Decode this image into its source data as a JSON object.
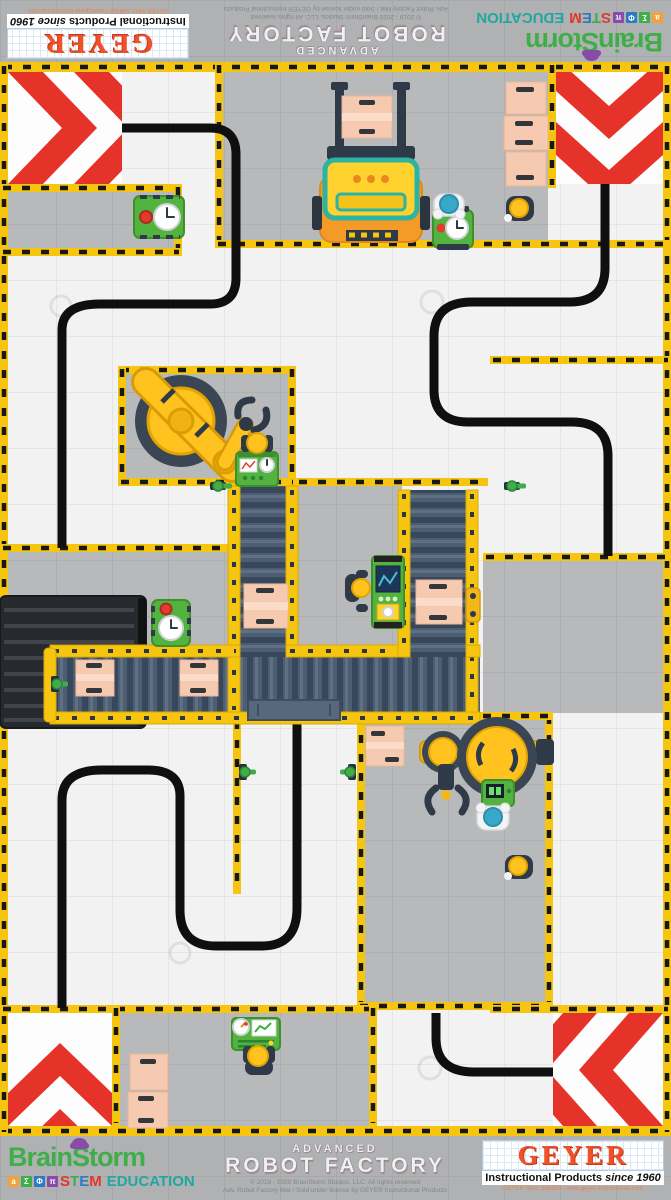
{
  "branding": {
    "brainstorm": {
      "name": "BrainStorm",
      "blocks": [
        "a",
        "Σ",
        "Φ",
        "π"
      ],
      "stem_letters": [
        "S",
        "T",
        "E",
        "M"
      ],
      "education": "EDUCATION"
    },
    "product": {
      "advanced": "ADVANCED",
      "robot_factory": "ROBOT FACTORY",
      "copyright": "© 2019 - 2020 BrainStorm Studios, LLC. All rights reserved",
      "license": "Adv. Robot Factory Mat / Sold under license by GEYER Instructional Products"
    },
    "geyer": {
      "name": "GEYER",
      "tagline_main": "Instructional Products",
      "tagline_italic": "since 1960",
      "contact": "GEYER SKU: 538503 / www.geyer-instructional.com"
    }
  },
  "mat": {
    "description": "Advanced Robot Factory line-following game mat",
    "objects": [
      "chevron-corner x4",
      "black-guide-line x4",
      "hazard-tape-border",
      "forklift",
      "cargo-truck",
      "robot-arm x2",
      "conveyor-belt x3",
      "loading-dock",
      "crate x10",
      "worker x7",
      "control-console x4",
      "timer-cart x3",
      "valve x5",
      "roller-cart"
    ],
    "colors": {
      "hazard_yellow": "#f6c50f",
      "chevron_red": "#e63329",
      "guide_line_black": "#0f0f10",
      "floor_white": "#f2f2f3",
      "zone_gray": "#b7b9bb",
      "conveyor_gray_blue": "#4e5e72",
      "machine_green": "#52b33e",
      "crate_pink": "#f5cab1",
      "arm_yellow": "#ffc21e",
      "forklift_orange": "#f49a26"
    }
  }
}
